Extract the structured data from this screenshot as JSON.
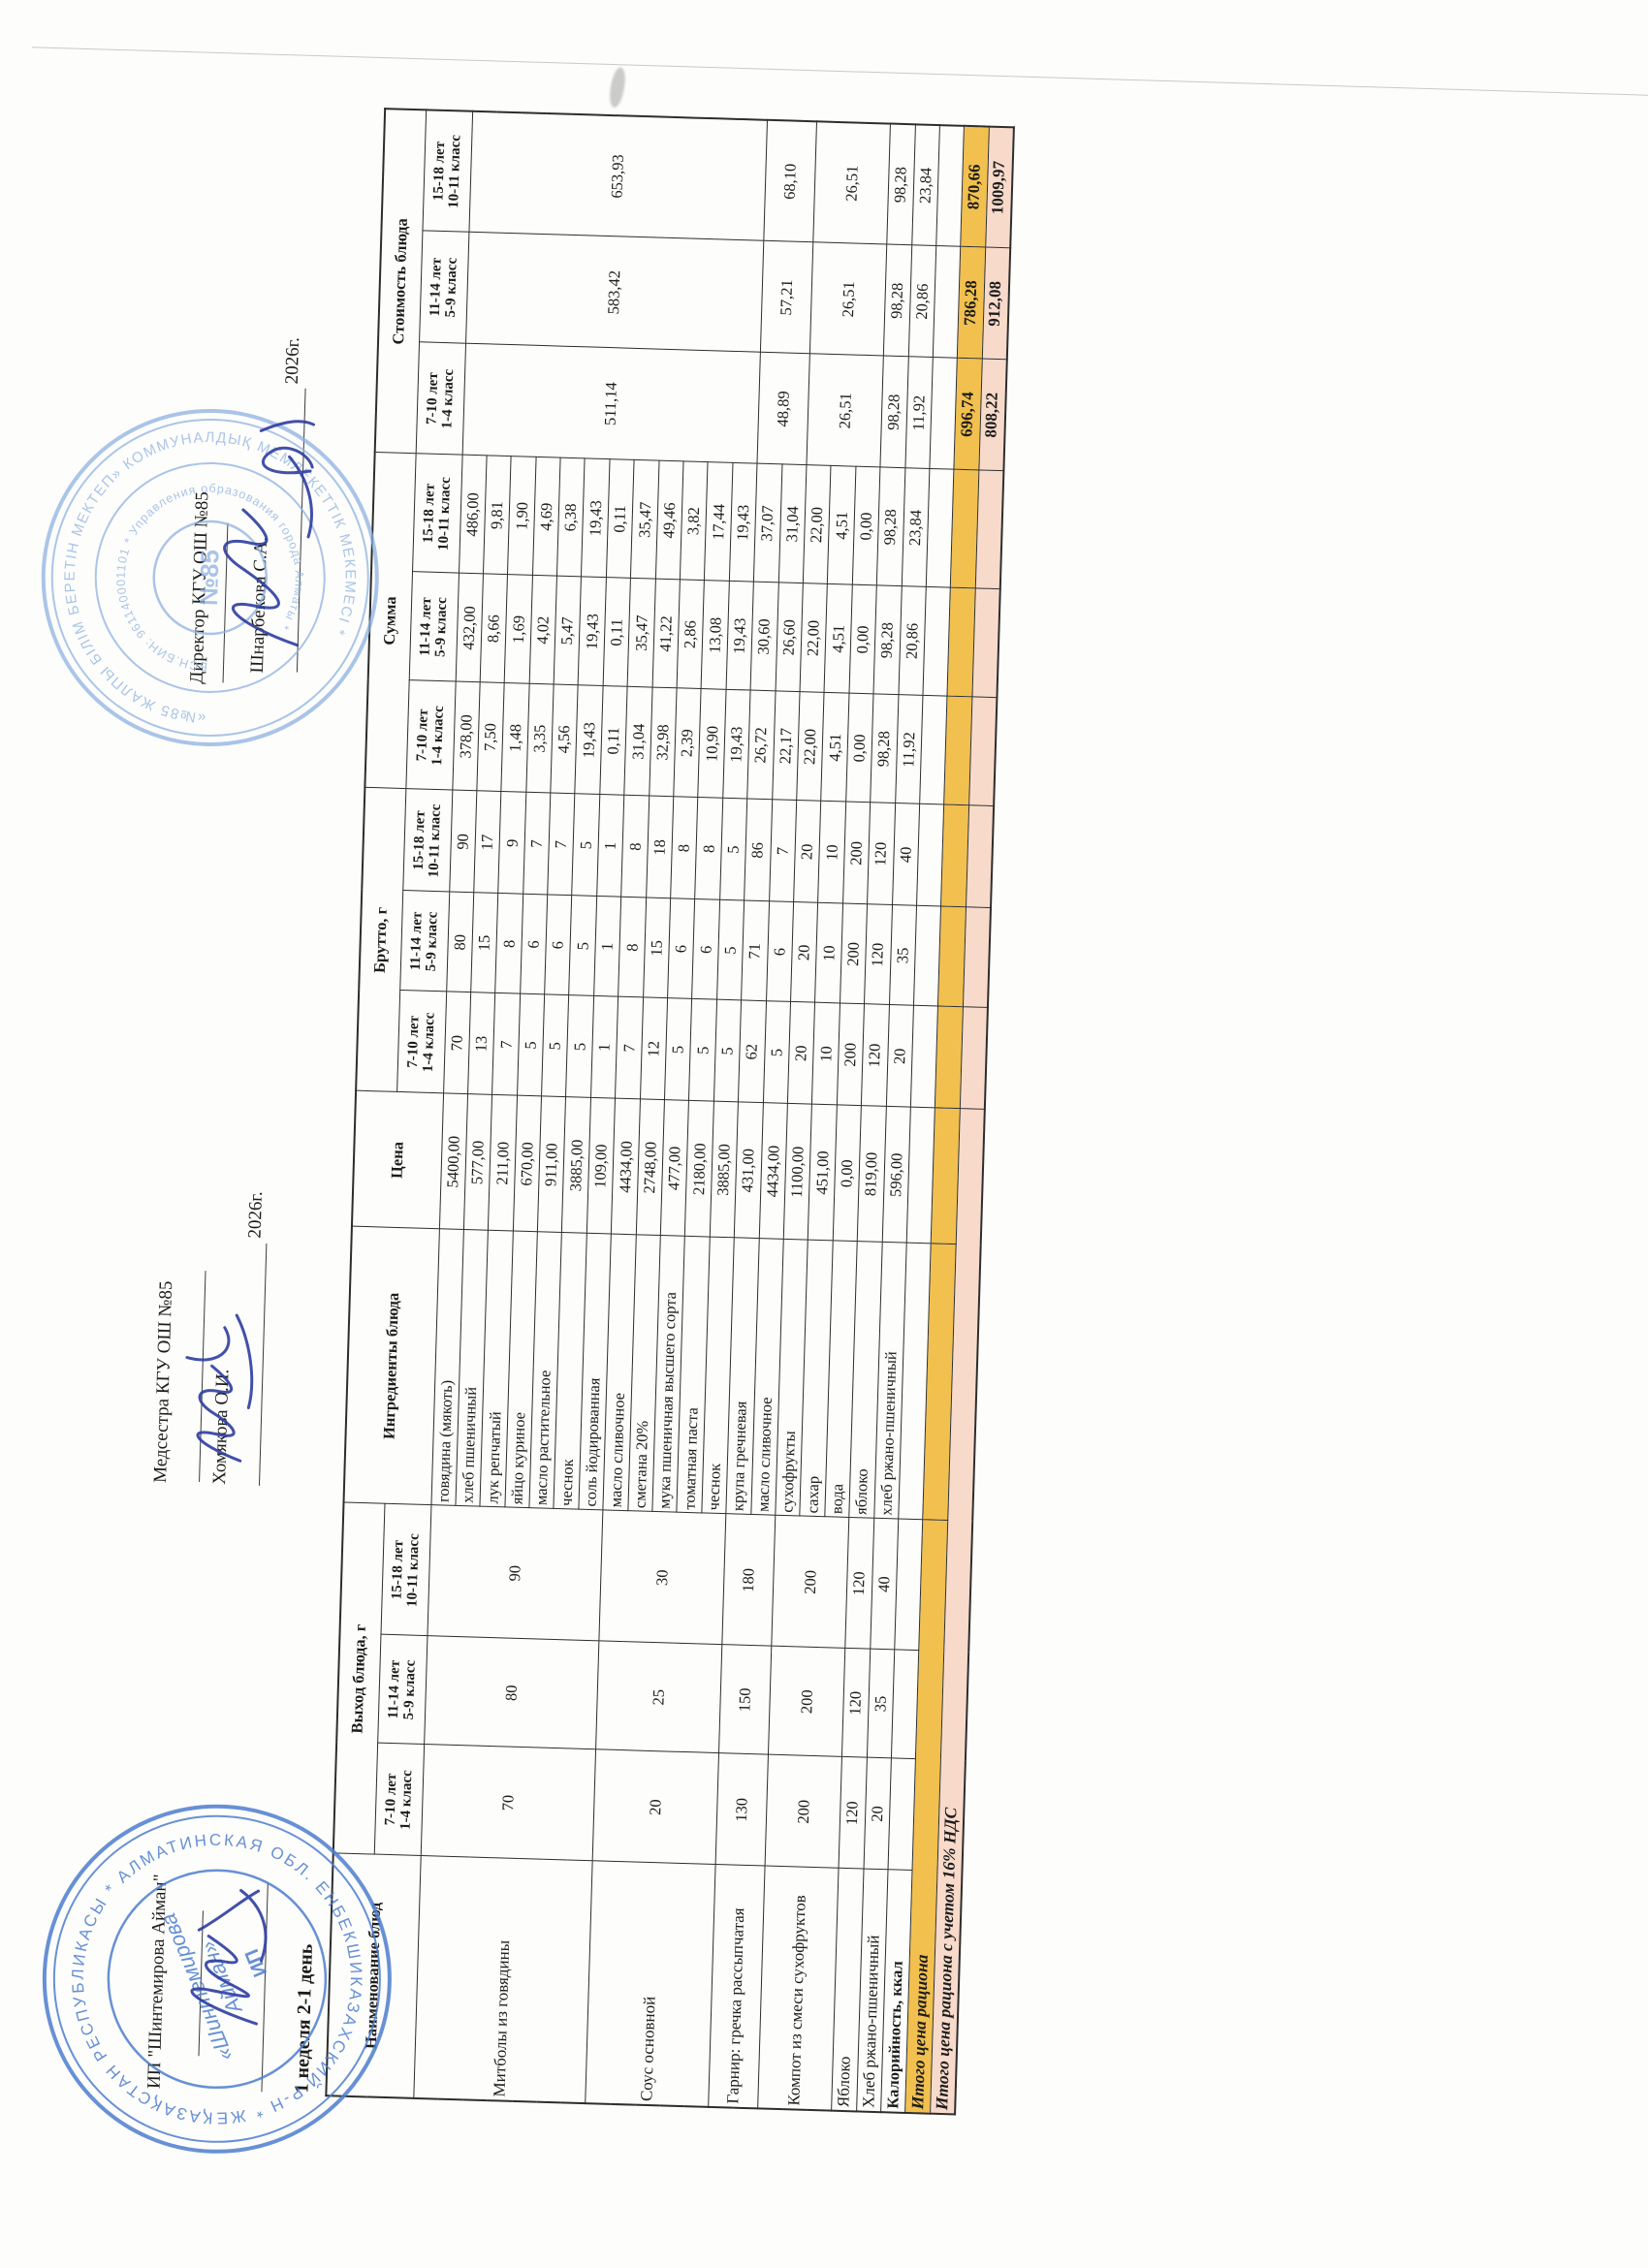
{
  "page": {
    "week_day_label": "1 неделя 2-1 день"
  },
  "signatures": {
    "ip": {
      "name": "ИП \"Шинтемирова Айман\""
    },
    "nurse": {
      "role": "Медсестра КГУ ОШ №85",
      "person": "Хомякова О.И.",
      "year": "2026г."
    },
    "director": {
      "role": "Директор КГУ ОШ №85",
      "person": "Шнарбекова С.А.",
      "year": "2026г."
    }
  },
  "stamps": {
    "ip_stamp": {
      "ring_text": "ҚАЗАҚСТАН РЕСПУБЛИКАСЫ * АЛМАТИНСКАЯ ОБЛ. ЕНБЕКШИКАЗАХСКИЙ Р-Н * ЖЕКЕ КӘСІПКЕР *",
      "center_text_1": "«Шинтемирова",
      "center_text_2": "Айман»",
      "center_text_3": "ИП",
      "color": "#4e7ecf"
    },
    "school_stamp": {
      "ring_text": "«№85 ЖАЛПЫ БІЛІМ БЕРЕТІН МЕКТЕП» КОММУНАЛДЫҚ МЕМЛЕКЕТТІК МЕКЕМЕСІ *",
      "inner_ring_text": "БСН.БИН: 961140001101 * Управления образования города Алматы *",
      "center_text": "№85",
      "color": "#8FB2E2"
    }
  },
  "table": {
    "columns": {
      "name": "Наименование блюд",
      "yield_group": "Выход блюда, г",
      "ingredients": "Ингредиенты блюда",
      "price": "Цена",
      "brutto_group": "Брутто, г",
      "sum_group": "Сумма",
      "cost_group": "Стоимость блюда",
      "age_subheaders": [
        [
          "7-10 лет",
          "1-4 класс"
        ],
        [
          "11-14 лет",
          "5-9 класс"
        ],
        [
          "15-18 лет",
          "10-11 класс"
        ]
      ]
    },
    "body": {
      "dishes": [
        {
          "name": "Митболы из говядины",
          "yield": [
            "70",
            "80",
            "90"
          ],
          "ingredients": [
            {
              "n": "говядина (мякоть)",
              "price": "5400,00",
              "brutto": [
                "70",
                "80",
                "90"
              ],
              "sum": [
                "378,00",
                "432,00",
                "486,00"
              ]
            },
            {
              "n": "хлеб пшеничный",
              "price": "577,00",
              "brutto": [
                "13",
                "15",
                "17"
              ],
              "sum": [
                "7,50",
                "8,66",
                "9,81"
              ]
            },
            {
              "n": "лук репчатый",
              "price": "211,00",
              "brutto": [
                "7",
                "8",
                "9"
              ],
              "sum": [
                "1,48",
                "1,69",
                "1,90"
              ]
            },
            {
              "n": "яйцо куриное",
              "price": "670,00",
              "brutto": [
                "5",
                "6",
                "7"
              ],
              "sum": [
                "3,35",
                "4,02",
                "4,69"
              ]
            },
            {
              "n": "масло растительное",
              "price": "911,00",
              "brutto": [
                "5",
                "6",
                "7"
              ],
              "sum": [
                "4,56",
                "5,47",
                "6,38"
              ]
            },
            {
              "n": "чеснок",
              "price": "3885,00",
              "brutto": [
                "5",
                "5",
                "5"
              ],
              "sum": [
                "19,43",
                "19,43",
                "19,43"
              ]
            },
            {
              "n": "соль йодированная",
              "price": "109,00",
              "brutto": [
                "1",
                "1",
                "1"
              ],
              "sum": [
                "0,11",
                "0,11",
                "0,11"
              ]
            }
          ]
        },
        {
          "name": "Соус основной",
          "yield": [
            "20",
            "25",
            "30"
          ],
          "ingredients": [
            {
              "n": "масло сливочное",
              "price": "4434,00",
              "brutto": [
                "7",
                "8",
                "8"
              ],
              "sum": [
                "31,04",
                "35,47",
                "35,47"
              ]
            },
            {
              "n": "сметана 20%",
              "price": "2748,00",
              "brutto": [
                "12",
                "15",
                "18"
              ],
              "sum": [
                "32,98",
                "41,22",
                "49,46"
              ]
            },
            {
              "n": "мука пшеничная высшего сорта",
              "price": "477,00",
              "brutto": [
                "5",
                "6",
                "8"
              ],
              "sum": [
                "2,39",
                "2,86",
                "3,82"
              ]
            },
            {
              "n": "томатная паста",
              "price": "2180,00",
              "brutto": [
                "5",
                "6",
                "8"
              ],
              "sum": [
                "10,90",
                "13,08",
                "17,44"
              ]
            },
            {
              "n": "чеснок",
              "price": "3885,00",
              "brutto": [
                "5",
                "5",
                "5"
              ],
              "sum": [
                "19,43",
                "19,43",
                "19,43"
              ]
            }
          ]
        },
        {
          "name": "Гарнир: гречка рассыпчатая",
          "yield": [
            "130",
            "150",
            "180"
          ],
          "ingredients": [
            {
              "n": "крупа гречневая",
              "price": "431,00",
              "brutto": [
                "62",
                "71",
                "86"
              ],
              "sum": [
                "26,72",
                "30,60",
                "37,07"
              ]
            },
            {
              "n": "масло сливочное",
              "price": "4434,00",
              "brutto": [
                "5",
                "6",
                "7"
              ],
              "sum": [
                "22,17",
                "26,60",
                "31,04"
              ]
            }
          ]
        },
        {
          "name": "Компот из смеси сухофруктов",
          "yield": [
            "200",
            "200",
            "200"
          ],
          "ingredients": [
            {
              "n": "сухофрукты",
              "price": "1100,00",
              "brutto": [
                "20",
                "20",
                "20"
              ],
              "sum": [
                "22,00",
                "22,00",
                "22,00"
              ]
            },
            {
              "n": "сахар",
              "price": "451,00",
              "brutto": [
                "10",
                "10",
                "10"
              ],
              "sum": [
                "4,51",
                "4,51",
                "4,51"
              ]
            },
            {
              "n": "вода",
              "price": "0,00",
              "brutto": [
                "200",
                "200",
                "200"
              ],
              "sum": [
                "0,00",
                "0,00",
                "0,00"
              ]
            }
          ]
        },
        {
          "name": "Яблоко",
          "yield": [
            "120",
            "120",
            "120"
          ],
          "ingredients": [
            {
              "n": "яблоко",
              "price": "819,00",
              "brutto": [
                "120",
                "120",
                "120"
              ],
              "sum": [
                "98,28",
                "98,28",
                "98,28"
              ]
            }
          ]
        },
        {
          "name": "Хлеб ржано-пшеничный",
          "yield": [
            "20",
            "35",
            "40"
          ],
          "ingredients": [
            {
              "n": "хлеб ржано-пшеничный",
              "price": "596,00",
              "brutto": [
                "20",
                "35",
                "40"
              ],
              "sum": [
                "11,92",
                "20,86",
                "23,84"
              ]
            }
          ]
        }
      ],
      "cost_spans": [
        {
          "dishes": [
            0,
            1
          ],
          "values": [
            "511,14",
            "583,42",
            "653,93"
          ]
        },
        {
          "dishes": [
            2
          ],
          "values": [
            "48,89",
            "57,21",
            "68,10"
          ]
        },
        {
          "dishes": [
            3
          ],
          "values": [
            "26,51",
            "26,51",
            "26,51"
          ]
        },
        {
          "dishes": [
            4
          ],
          "values": [
            "98,28",
            "98,28",
            "98,28"
          ]
        },
        {
          "dishes": [
            5
          ],
          "values": [
            "11,92",
            "20,86",
            "23,84"
          ]
        }
      ],
      "kcal_row": {
        "label": "Калорийность, ккал"
      },
      "totals": [
        {
          "label": "Итого цена рациона",
          "values": [
            "696,74",
            "786,28",
            "870,66"
          ],
          "style": "orange"
        },
        {
          "label": "Итого цена рациона с учетом 16% НДС",
          "values": [
            "808,22",
            "912,08",
            "1009,97"
          ],
          "style": "pink"
        }
      ]
    }
  }
}
